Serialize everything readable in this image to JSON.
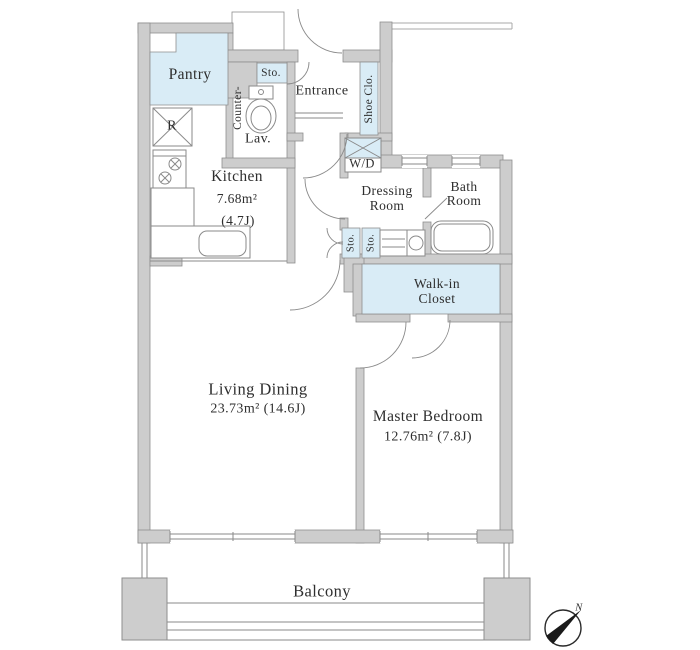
{
  "labels": {
    "pantry": "Pantry",
    "sto_entrance": "Sto.",
    "entrance": "Entrance",
    "shoe_closet": "Shoe Clo.",
    "counter": "Counter-",
    "lav": "Lav.",
    "refrigerator": "R",
    "washer_dryer": "W/D",
    "kitchen": "Kitchen",
    "kitchen_area_sqm": "7.68m²",
    "kitchen_area_jo": "(4.7J)",
    "dressing_line1": "Dressing",
    "dressing_line2": "Room",
    "bath_line1": "Bath",
    "bath_line2": "Room",
    "sto_hall_left": "Sto.",
    "sto_hall_right": "Sto.",
    "walkin_line1": "Walk-in",
    "walkin_line2": "Closet",
    "living": "Living Dining",
    "living_area": "23.73m²  (14.6J)",
    "master": "Master Bedroom",
    "master_area": "12.76m²  (7.8J)",
    "balcony": "Balcony",
    "compass_north": "N"
  },
  "colors": {
    "wall": "#cdcdcd",
    "wall_stroke": "#8e8e8e",
    "highlight": "#d9ecf6",
    "line": "#8a8a8a",
    "text": "#2e2e2e",
    "thin": "#aaaaaa"
  }
}
